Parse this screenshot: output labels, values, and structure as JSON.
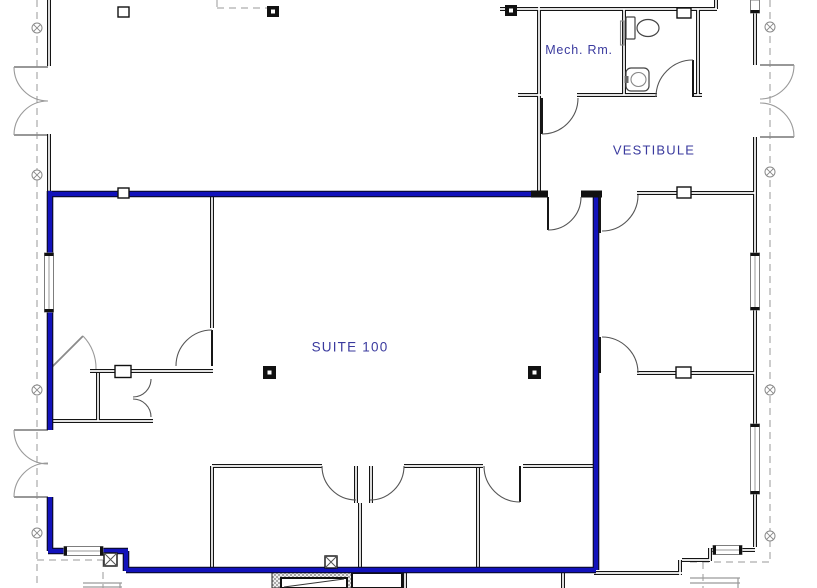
{
  "drawing": {
    "type": "architectural-floor-plan",
    "labels": {
      "mech_room": "Mech. Rm.",
      "vestibule": "VESTIBULE",
      "suite": "SUITE 100"
    },
    "colors": {
      "suite_boundary": "#1212bb",
      "label_text": "#3a3a9e",
      "walls": "#141414"
    },
    "icons": [
      "toilet-icon",
      "sink-icon",
      "door-swing-icon",
      "column-marker-icon",
      "grid-bubble-icon",
      "stair-shaft-icon"
    ]
  }
}
